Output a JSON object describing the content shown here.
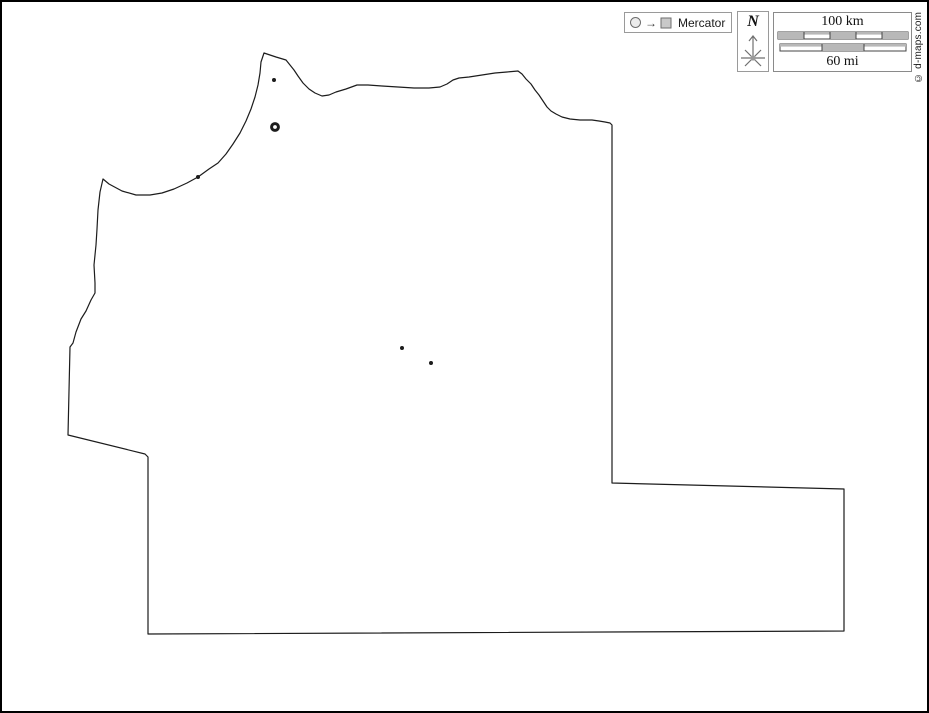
{
  "legend": {
    "projection": "Mercator"
  },
  "compass": {
    "north_label": "N"
  },
  "scale_bar": {
    "km_label": "100 km",
    "mi_label": "60 mi",
    "km_segments": 5,
    "mi_segments": 3
  },
  "copyright": "© d-maps.com",
  "map": {
    "type": "blank-outline-map",
    "background": "#ffffff",
    "outline_color": "#1c1c1c",
    "outline_path": "M101,177 L107,182 L120,189 L134,193 L148,193 L160,191 L172,187 L185,181 L196,175 L207,167 L216,161 L224,152 L231,142 L238,131 L244,119 L249,107 L253,95 L256,83 L258,71 L259,60 L262,51 L268,53 L274,55 L284,58 L288,63 L292,68 L296,74 L301,81 L307,87 L313,91 L320,94 L327,93 L334,90 L344,87 L355,83 L366,83 L380,84 L396,85 L412,86 L427,86 L438,85 L445,82 L451,78 L457,76 L467,75 L480,73 L493,71 L505,70 L516,69 L520,72 L524,77 L529,82 L533,88 L537,93 L541,99 L545,105 L549,109 L554,112 L560,115 L568,117 L578,118 L590,118 L597,119 L603,120 L608,121 L610,123 L610,481 L842,487 L842,629 L146,632 L146,455 L143,452 L66,433 L68,345 L71,341 L74,330 L79,317 L84,309 L89,298 L93,291 L93,281 L92,263 L94,243 L95,227 L96,208 L98,190 Z",
    "city_markers": [
      {
        "kind": "capital-ring",
        "x": 273,
        "y": 125
      },
      {
        "kind": "dot",
        "x": 272,
        "y": 78
      },
      {
        "kind": "dot",
        "x": 196,
        "y": 175
      },
      {
        "kind": "dot",
        "x": 400,
        "y": 346
      },
      {
        "kind": "dot",
        "x": 429,
        "y": 361
      }
    ]
  }
}
